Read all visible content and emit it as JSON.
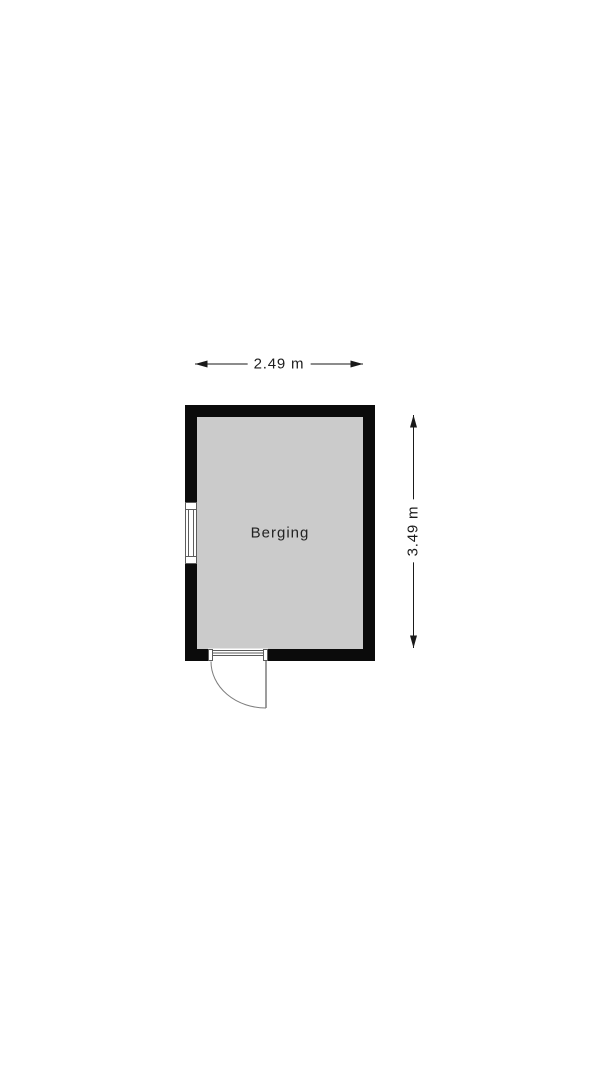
{
  "floorplan": {
    "room_label": "Berging",
    "width_dimension": "2.49 m",
    "height_dimension": "3.49 m",
    "fixtures": {
      "window": "window-left-wall",
      "door": "hinged-door-bottom-wall-swing-outward"
    }
  },
  "colors": {
    "background": "#ffffff",
    "wall": "#0b0b0b",
    "floor": "#cbcbcb",
    "dimension": "#1a1a1a",
    "fixture_fill": "#ffffff",
    "fixture_stroke": "#5c5c5c",
    "door_arc": "#7d7d7d",
    "room_text": "#222222"
  }
}
